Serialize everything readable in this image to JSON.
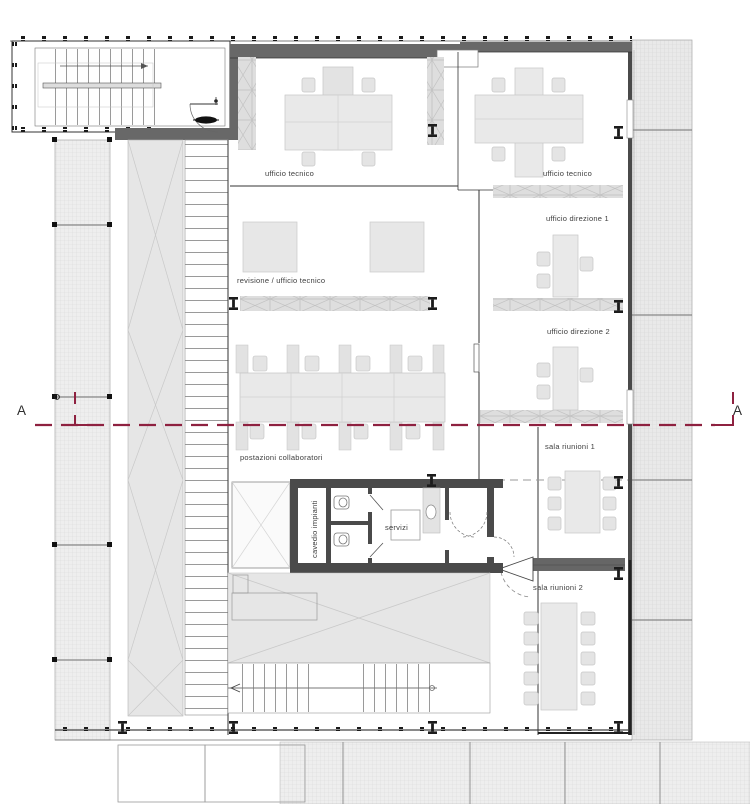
{
  "plan": {
    "rooms": {
      "ufficio_tecnico_left": "ufficio tecnico",
      "ufficio_tecnico_right": "ufficio tecnico",
      "ufficio_direzione_1": "ufficio direzione 1",
      "ufficio_direzione_2": "ufficio direzione 2",
      "sala_riunioni_1": "sala riunioni 1",
      "sala_riunioni_2": "sala riunioni 2",
      "revisione": "revisione / ufficio tecnico",
      "postazioni": "postazioni collaboratori",
      "servizi": "servizi",
      "cavedio": "cavedio impianti"
    },
    "section": {
      "left_mark": "A",
      "right_mark": "A"
    },
    "colors": {
      "section_line": "#8e2140",
      "wall_dark": "#4a4a4a",
      "wall_medium": "#686868",
      "furniture_fill": "#e9e9e9",
      "hatch_base": "#ededed",
      "gray_area": "#e6e6e6"
    }
  }
}
